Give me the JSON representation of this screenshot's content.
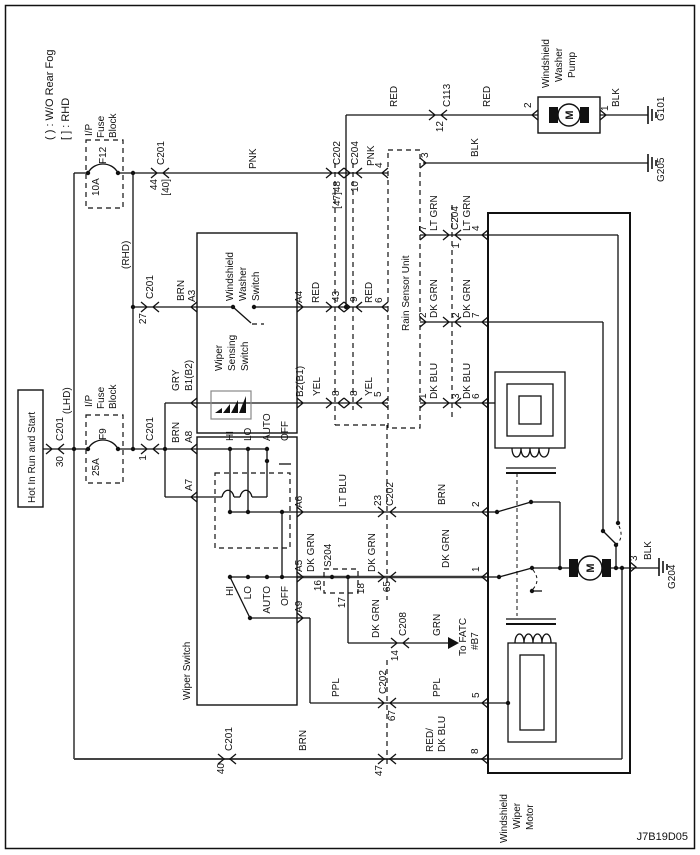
{
  "meta": {
    "type": "wiring-diagram",
    "system": "Windshield Wiper / Washer with Rain Sensor",
    "diagram_id": "J7B19D05",
    "colors": {
      "line": "#111111",
      "background": "#ffffff",
      "heavy_line": "#3a3a3a"
    }
  },
  "legend": {
    "line1": "( ) : W/O Rear Fog",
    "line2": "[ ] : RHD"
  },
  "components": [
    "Hot In Run and Start",
    "I/P Fuse Block F12 10A",
    "I/P Fuse Block F9 25A",
    "Windshield Washer Switch",
    "Wiper Sensing Switch",
    "Wiper Switch",
    "Rain Sensor Unit",
    "Windshield Washer Pump",
    "Windshield Wiper Motor",
    "S204 splice",
    "Grounds G101 G205 G204",
    "To FATC #B7"
  ],
  "labels": [
    {
      "n": "legend-wo-rear-fog",
      "t": "( ) : W/O Rear Fog",
      "x": 53,
      "y": 140,
      "a": "s",
      "s": 11
    },
    {
      "n": "legend-rhd",
      "t": "[ ] : RHD",
      "x": 69,
      "y": 140,
      "a": "s",
      "s": 11
    },
    {
      "n": "diagram-id",
      "t": "J7B19D05",
      "x": 688,
      "y": 840,
      "a": "e",
      "s": 11,
      "rot": 0
    },
    {
      "n": "hot-label",
      "t": "Hot In Run and Start",
      "x": 35,
      "y": 503,
      "a": "s",
      "s": 10
    },
    {
      "n": "connector-c201-30-name",
      "t": "C201",
      "x": 63,
      "y": 441,
      "a": "s",
      "s": 10
    },
    {
      "n": "connector-c201-30-pin",
      "t": "30",
      "x": 63,
      "y": 456,
      "a": "e",
      "s": 10
    },
    {
      "n": "lhd-label",
      "t": "(LHD)",
      "x": 70,
      "y": 414,
      "a": "s",
      "s": 10
    },
    {
      "n": "fuse-f12-block-l1",
      "t": "I/P",
      "x": 92,
      "y": 136,
      "a": "s",
      "s": 10
    },
    {
      "n": "fuse-f12-block-l2",
      "t": "Fuse",
      "x": 104,
      "y": 138,
      "a": "s",
      "s": 10
    },
    {
      "n": "fuse-f12-block-l3",
      "t": "Block",
      "x": 116,
      "y": 138,
      "a": "s",
      "s": 10
    },
    {
      "n": "fuse-f12-rating",
      "t": "10A",
      "x": 99,
      "y": 196,
      "a": "s",
      "s": 10
    },
    {
      "n": "fuse-f12-id",
      "t": "F12",
      "x": 106,
      "y": 164,
      "a": "s",
      "s": 10
    },
    {
      "n": "fuse-f9-block-l1",
      "t": "I/P",
      "x": 92,
      "y": 407,
      "a": "s",
      "s": 10
    },
    {
      "n": "fuse-f9-block-l2",
      "t": "Fuse",
      "x": 104,
      "y": 409,
      "a": "s",
      "s": 10
    },
    {
      "n": "fuse-f9-block-l3",
      "t": "Block",
      "x": 116,
      "y": 409,
      "a": "s",
      "s": 10
    },
    {
      "n": "fuse-f9-rating",
      "t": "25A",
      "x": 99,
      "y": 476,
      "a": "s",
      "s": 10
    },
    {
      "n": "fuse-f9-id",
      "t": "F9",
      "x": 106,
      "y": 440,
      "a": "s",
      "s": 10
    },
    {
      "n": "connector-c201-44-name",
      "t": "C201",
      "x": 164,
      "y": 165,
      "a": "s",
      "s": 10
    },
    {
      "n": "connector-c201-44-pin",
      "t": "44",
      "x": 157,
      "y": 179,
      "a": "e",
      "s": 10
    },
    {
      "n": "connector-c201-44-pin-alt",
      "t": "[40]",
      "x": 169,
      "y": 179,
      "a": "e",
      "s": 10
    },
    {
      "n": "wire-pnk-1",
      "t": "PNK",
      "x": 256,
      "y": 169,
      "a": "s",
      "s": 10
    },
    {
      "n": "connector-c202-47-name",
      "t": "C202",
      "x": 340,
      "y": 165,
      "a": "s",
      "s": 10
    },
    {
      "n": "connector-c202-47-pin",
      "t": "[47]48",
      "x": 340,
      "y": 181,
      "a": "e",
      "s": 10
    },
    {
      "n": "connector-c204-10-name",
      "t": "C204",
      "x": 358,
      "y": 165,
      "a": "s",
      "s": 10
    },
    {
      "n": "connector-c204-10-pin",
      "t": "10",
      "x": 358,
      "y": 181,
      "a": "e",
      "s": 10
    },
    {
      "n": "wire-pnk-2",
      "t": "PNK",
      "x": 374,
      "y": 166,
      "a": "s",
      "s": 10
    },
    {
      "n": "rain-pin-4",
      "t": "4",
      "x": 382,
      "y": 168,
      "a": "s",
      "s": 10
    },
    {
      "n": "rhd-label",
      "t": "(RHD)",
      "x": 129,
      "y": 269,
      "a": "s",
      "s": 10
    },
    {
      "n": "connector-c201-27-name",
      "t": "C201",
      "x": 153,
      "y": 299,
      "a": "s",
      "s": 10
    },
    {
      "n": "connector-c201-27-pin",
      "t": "27",
      "x": 146,
      "y": 313,
      "a": "e",
      "s": 10
    },
    {
      "n": "wire-brn-a3",
      "t": "BRN",
      "x": 184,
      "y": 301,
      "a": "s",
      "s": 10
    },
    {
      "n": "pin-a3",
      "t": "A3",
      "x": 195,
      "y": 302,
      "a": "s",
      "s": 10
    },
    {
      "n": "washer-switch-label-l1",
      "t": "Windshield",
      "x": 233,
      "y": 301,
      "a": "s",
      "s": 10
    },
    {
      "n": "washer-switch-label-l2",
      "t": "Washer",
      "x": 246,
      "y": 301,
      "a": "s",
      "s": 10
    },
    {
      "n": "washer-switch-label-l3",
      "t": "Switch",
      "x": 259,
      "y": 301,
      "a": "s",
      "s": 10
    },
    {
      "n": "sensing-switch-label-l1",
      "t": "Wiper",
      "x": 222,
      "y": 371,
      "a": "s",
      "s": 10
    },
    {
      "n": "sensing-switch-label-l2",
      "t": "Sensing",
      "x": 235,
      "y": 371,
      "a": "s",
      "s": 10
    },
    {
      "n": "sensing-switch-label-l3",
      "t": "Switch",
      "x": 248,
      "y": 371,
      "a": "s",
      "s": 10
    },
    {
      "n": "pin-a4",
      "t": "A4",
      "x": 302,
      "y": 303,
      "a": "s",
      "s": 10
    },
    {
      "n": "wire-red-1",
      "t": "RED",
      "x": 319,
      "y": 303,
      "a": "s",
      "s": 10
    },
    {
      "n": "connector-c202-43-pin",
      "t": "43",
      "x": 339,
      "y": 302,
      "a": "s",
      "s": 10
    },
    {
      "n": "connector-c204-9-pin",
      "t": "9",
      "x": 357,
      "y": 302,
      "a": "s",
      "s": 10
    },
    {
      "n": "wire-red-2",
      "t": "RED",
      "x": 372,
      "y": 303,
      "a": "s",
      "s": 10
    },
    {
      "n": "rain-pin-6",
      "t": "6",
      "x": 382,
      "y": 303,
      "a": "s",
      "s": 10
    },
    {
      "n": "wire-red-3",
      "t": "RED",
      "x": 397,
      "y": 107,
      "a": "s",
      "s": 10
    },
    {
      "n": "connector-c113-name",
      "t": "C113",
      "x": 450,
      "y": 107,
      "a": "s",
      "s": 10
    },
    {
      "n": "connector-c113-pin",
      "t": "12",
      "x": 443,
      "y": 121,
      "a": "e",
      "s": 10
    },
    {
      "n": "wire-red-4",
      "t": "RED",
      "x": 490,
      "y": 107,
      "a": "s",
      "s": 10
    },
    {
      "n": "pump-pin-2",
      "t": "2",
      "x": 531,
      "y": 108,
      "a": "s",
      "s": 10
    },
    {
      "n": "washer-pump-label-l1",
      "t": "Windshield",
      "x": 549,
      "y": 88,
      "a": "s",
      "s": 10
    },
    {
      "n": "washer-pump-label-l2",
      "t": "Washer",
      "x": 562,
      "y": 82,
      "a": "s",
      "s": 10
    },
    {
      "n": "washer-pump-label-l3",
      "t": "Pump",
      "x": 575,
      "y": 78,
      "a": "s",
      "s": 10
    },
    {
      "n": "pump-pin-1",
      "t": "1",
      "x": 608,
      "y": 111,
      "a": "s",
      "s": 10
    },
    {
      "n": "wire-blk-1",
      "t": "BLK",
      "x": 619,
      "y": 107,
      "a": "s",
      "s": 10
    },
    {
      "n": "ground-g101-label",
      "t": "G101",
      "x": 664,
      "y": 121,
      "a": "s",
      "s": 10
    },
    {
      "n": "rain-pin-3",
      "t": "3",
      "x": 428,
      "y": 158,
      "a": "s",
      "s": 10
    },
    {
      "n": "wire-blk-2",
      "t": "BLK",
      "x": 478,
      "y": 157,
      "a": "s",
      "s": 10
    },
    {
      "n": "ground-g205-label",
      "t": "G205",
      "x": 664,
      "y": 182,
      "a": "s",
      "s": 10
    },
    {
      "n": "rain-sensor-label",
      "t": "Rain Sensor Unit",
      "x": 409,
      "y": 331,
      "a": "s",
      "s": 10
    },
    {
      "n": "rain-pin-7",
      "t": "7",
      "x": 426,
      "y": 231,
      "a": "s",
      "s": 10
    },
    {
      "n": "wire-ltgrn-1",
      "t": "LT GRN",
      "x": 437,
      "y": 231,
      "a": "s",
      "s": 10
    },
    {
      "n": "connector-c204r-name",
      "t": "C204",
      "x": 458,
      "y": 230,
      "a": "s",
      "s": 10
    },
    {
      "n": "connector-c204r-pin1",
      "t": "1",
      "x": 459,
      "y": 243,
      "a": "e",
      "s": 10
    },
    {
      "n": "wire-ltgrn-2",
      "t": "LT GRN",
      "x": 470,
      "y": 231,
      "a": "s",
      "s": 10
    },
    {
      "n": "motor-pin-4",
      "t": "4",
      "x": 479,
      "y": 231,
      "a": "s",
      "s": 10
    },
    {
      "n": "rain-pin-2",
      "t": "2",
      "x": 426,
      "y": 318,
      "a": "s",
      "s": 10
    },
    {
      "n": "wire-dkgrn-r1",
      "t": "DK GRN",
      "x": 437,
      "y": 318,
      "a": "s",
      "s": 10
    },
    {
      "n": "connector-c204r-pin2",
      "t": "2",
      "x": 459,
      "y": 318,
      "a": "s",
      "s": 10
    },
    {
      "n": "wire-dkgrn-r2",
      "t": "DK GRN",
      "x": 470,
      "y": 318,
      "a": "s",
      "s": 10
    },
    {
      "n": "motor-pin-7",
      "t": "7",
      "x": 479,
      "y": 318,
      "a": "s",
      "s": 10
    },
    {
      "n": "rain-pin-1",
      "t": "1",
      "x": 426,
      "y": 399,
      "a": "s",
      "s": 10
    },
    {
      "n": "wire-dkblu-1",
      "t": "DK BLU",
      "x": 437,
      "y": 399,
      "a": "s",
      "s": 10
    },
    {
      "n": "connector-c204r-pin3",
      "t": "3",
      "x": 459,
      "y": 399,
      "a": "s",
      "s": 10
    },
    {
      "n": "wire-dkblu-2",
      "t": "DK BLU",
      "x": 470,
      "y": 399,
      "a": "s",
      "s": 10
    },
    {
      "n": "motor-pin-6",
      "t": "6",
      "x": 479,
      "y": 399,
      "a": "s",
      "s": 10
    },
    {
      "n": "wire-gry",
      "t": "GRY",
      "x": 179,
      "y": 391,
      "a": "s",
      "s": 10
    },
    {
      "n": "pin-b1",
      "t": "B1(B2)",
      "x": 192,
      "y": 391,
      "a": "s",
      "s": 10
    },
    {
      "n": "wire-brn-a8",
      "t": "BRN",
      "x": 179,
      "y": 443,
      "a": "s",
      "s": 10
    },
    {
      "n": "pin-a8",
      "t": "A8",
      "x": 192,
      "y": 443,
      "a": "s",
      "s": 10
    },
    {
      "n": "pin-a7",
      "t": "A7",
      "x": 192,
      "y": 491,
      "a": "s",
      "s": 10
    },
    {
      "n": "connector-c201-1-name",
      "t": "C201",
      "x": 153,
      "y": 441,
      "a": "s",
      "s": 10
    },
    {
      "n": "connector-c201-1-pin",
      "t": "1",
      "x": 146,
      "y": 455,
      "a": "e",
      "s": 10
    },
    {
      "n": "pin-b2",
      "t": "B2(B1)",
      "x": 303,
      "y": 397,
      "a": "s",
      "s": 10
    },
    {
      "n": "wire-yel-1",
      "t": "YEL",
      "x": 320,
      "y": 396,
      "a": "s",
      "s": 10
    },
    {
      "n": "connector-c202-8-pin",
      "t": "8",
      "x": 339,
      "y": 396,
      "a": "s",
      "s": 10
    },
    {
      "n": "connector-c204-8-pin",
      "t": "8",
      "x": 357,
      "y": 396,
      "a": "s",
      "s": 10
    },
    {
      "n": "wire-yel-2",
      "t": "YEL",
      "x": 372,
      "y": 396,
      "a": "s",
      "s": 10
    },
    {
      "n": "rain-pin-5",
      "t": "5",
      "x": 381,
      "y": 397,
      "a": "s",
      "s": 10
    },
    {
      "n": "switch1-hi",
      "t": "HI",
      "x": 233,
      "y": 441,
      "a": "s",
      "s": 10
    },
    {
      "n": "switch1-lo",
      "t": "LO",
      "x": 251,
      "y": 441,
      "a": "s",
      "s": 10
    },
    {
      "n": "switch1-auto",
      "t": "AUTO",
      "x": 270,
      "y": 441,
      "a": "s",
      "s": 10
    },
    {
      "n": "switch1-off",
      "t": "OFF",
      "x": 288,
      "y": 441,
      "a": "s",
      "s": 10
    },
    {
      "n": "switch2-hi",
      "t": "HI",
      "x": 233,
      "y": 586,
      "a": "e",
      "s": 10
    },
    {
      "n": "switch2-lo",
      "t": "LO",
      "x": 251,
      "y": 586,
      "a": "e",
      "s": 10
    },
    {
      "n": "switch2-auto",
      "t": "AUTO",
      "x": 270,
      "y": 586,
      "a": "e",
      "s": 10
    },
    {
      "n": "switch2-off",
      "t": "OFF",
      "x": 288,
      "y": 586,
      "a": "e",
      "s": 10
    },
    {
      "n": "pin-a6",
      "t": "A6",
      "x": 302,
      "y": 508,
      "a": "s",
      "s": 10
    },
    {
      "n": "wire-ltblu",
      "t": "LT BLU",
      "x": 346,
      "y": 507,
      "a": "s",
      "s": 10
    },
    {
      "n": "connector-c202-23-pin",
      "t": "23",
      "x": 381,
      "y": 506,
      "a": "s",
      "s": 10
    },
    {
      "n": "connector-c202-23-name",
      "t": "C202",
      "x": 393,
      "y": 506,
      "a": "s",
      "s": 10
    },
    {
      "n": "wire-brn-2",
      "t": "BRN",
      "x": 445,
      "y": 505,
      "a": "s",
      "s": 10
    },
    {
      "n": "motor-pin-2",
      "t": "2",
      "x": 479,
      "y": 507,
      "a": "s",
      "s": 10
    },
    {
      "n": "pin-a5",
      "t": "A5",
      "x": 302,
      "y": 572,
      "a": "s",
      "s": 10
    },
    {
      "n": "wire-dkgrn-1",
      "t": "DK GRN",
      "x": 314,
      "y": 572,
      "a": "s",
      "s": 10
    },
    {
      "n": "splice-s204-pin16",
      "t": "16",
      "x": 321,
      "y": 580,
      "a": "e",
      "s": 10
    },
    {
      "n": "splice-s204-name",
      "t": "S204",
      "x": 331,
      "y": 567,
      "a": "s",
      "s": 10
    },
    {
      "n": "splice-s204-pin17",
      "t": "17",
      "x": 345,
      "y": 597,
      "a": "e",
      "s": 10
    },
    {
      "n": "splice-s204-pin18",
      "t": "18",
      "x": 364,
      "y": 583,
      "a": "e",
      "s": 10
    },
    {
      "n": "wire-dkgrn-2",
      "t": "DK GRN",
      "x": 375,
      "y": 572,
      "a": "s",
      "s": 10
    },
    {
      "n": "connector-c202-65-pin",
      "t": "65",
      "x": 390,
      "y": 581,
      "a": "e",
      "s": 10
    },
    {
      "n": "wire-dkgrn-3",
      "t": "DK GRN",
      "x": 449,
      "y": 568,
      "a": "s",
      "s": 10
    },
    {
      "n": "motor-pin-1",
      "t": "1",
      "x": 479,
      "y": 572,
      "a": "s",
      "s": 10
    },
    {
      "n": "wire-dkgrn-4",
      "t": "DK GRN",
      "x": 379,
      "y": 638,
      "a": "s",
      "s": 10
    },
    {
      "n": "connector-c208-name",
      "t": "C208",
      "x": 406,
      "y": 636,
      "a": "s",
      "s": 10
    },
    {
      "n": "connector-c208-pin",
      "t": "14",
      "x": 398,
      "y": 650,
      "a": "e",
      "s": 10
    },
    {
      "n": "wire-grn",
      "t": "GRN",
      "x": 440,
      "y": 636,
      "a": "s",
      "s": 10
    },
    {
      "n": "fatc-label-l1",
      "t": "To FATC",
      "x": 466,
      "y": 656,
      "a": "s",
      "s": 10
    },
    {
      "n": "fatc-label-l2",
      "t": "#B7",
      "x": 478,
      "y": 650,
      "a": "s",
      "s": 10
    },
    {
      "n": "pin-a9",
      "t": "A9",
      "x": 302,
      "y": 613,
      "a": "s",
      "s": 10
    },
    {
      "n": "wire-ppl-1",
      "t": "PPL",
      "x": 339,
      "y": 697,
      "a": "s",
      "s": 10
    },
    {
      "n": "connector-c202-67-name",
      "t": "C202",
      "x": 386,
      "y": 694,
      "a": "s",
      "s": 10
    },
    {
      "n": "connector-c202-67-pin",
      "t": "67",
      "x": 395,
      "y": 710,
      "a": "e",
      "s": 10
    },
    {
      "n": "wire-ppl-2",
      "t": "PPL",
      "x": 440,
      "y": 697,
      "a": "s",
      "s": 10
    },
    {
      "n": "motor-pin-5",
      "t": "5",
      "x": 479,
      "y": 698,
      "a": "s",
      "s": 10
    },
    {
      "n": "connector-c201-40-name",
      "t": "C201",
      "x": 232,
      "y": 751,
      "a": "s",
      "s": 10
    },
    {
      "n": "connector-c201-40-pin",
      "t": "40",
      "x": 224,
      "y": 763,
      "a": "e",
      "s": 10
    },
    {
      "n": "wire-brn-3",
      "t": "BRN",
      "x": 306,
      "y": 751,
      "a": "s",
      "s": 10
    },
    {
      "n": "connector-c202-47b-pin",
      "t": "47",
      "x": 382,
      "y": 765,
      "a": "e",
      "s": 10
    },
    {
      "n": "wire-redblu-l1",
      "t": "RED/",
      "x": 433,
      "y": 752,
      "a": "s",
      "s": 10
    },
    {
      "n": "wire-redblu-l2",
      "t": "DK BLU",
      "x": 445,
      "y": 752,
      "a": "s",
      "s": 10
    },
    {
      "n": "motor-pin-8",
      "t": "8",
      "x": 478,
      "y": 754,
      "a": "s",
      "s": 10
    },
    {
      "n": "motor-pin-3",
      "t": "3",
      "x": 637,
      "y": 561,
      "a": "s",
      "s": 10
    },
    {
      "n": "wire-blk-3",
      "t": "BLK",
      "x": 651,
      "y": 560,
      "a": "s",
      "s": 10
    },
    {
      "n": "ground-g204-label",
      "t": "G204",
      "x": 675,
      "y": 589,
      "a": "s",
      "s": 10
    },
    {
      "n": "wiper-switch-label",
      "t": "Wiper Switch",
      "x": 190,
      "y": 700,
      "a": "s",
      "s": 10
    },
    {
      "n": "wiper-motor-label-l1",
      "t": "Windshield",
      "x": 507,
      "y": 843,
      "a": "s",
      "s": 10
    },
    {
      "n": "wiper-motor-label-l2",
      "t": "Wiper",
      "x": 520,
      "y": 829,
      "a": "s",
      "s": 10
    },
    {
      "n": "wiper-motor-label-l3",
      "t": "Motor",
      "x": 533,
      "y": 830,
      "a": "s",
      "s": 10
    },
    {
      "n": "pump-motor-m",
      "t": "M",
      "x": 573,
      "y": 115,
      "a": "m",
      "s": 11,
      "b": 1
    },
    {
      "n": "wiper-motor-m",
      "t": "M",
      "x": 594,
      "y": 568,
      "a": "m",
      "s": 11,
      "b": 1
    }
  ]
}
